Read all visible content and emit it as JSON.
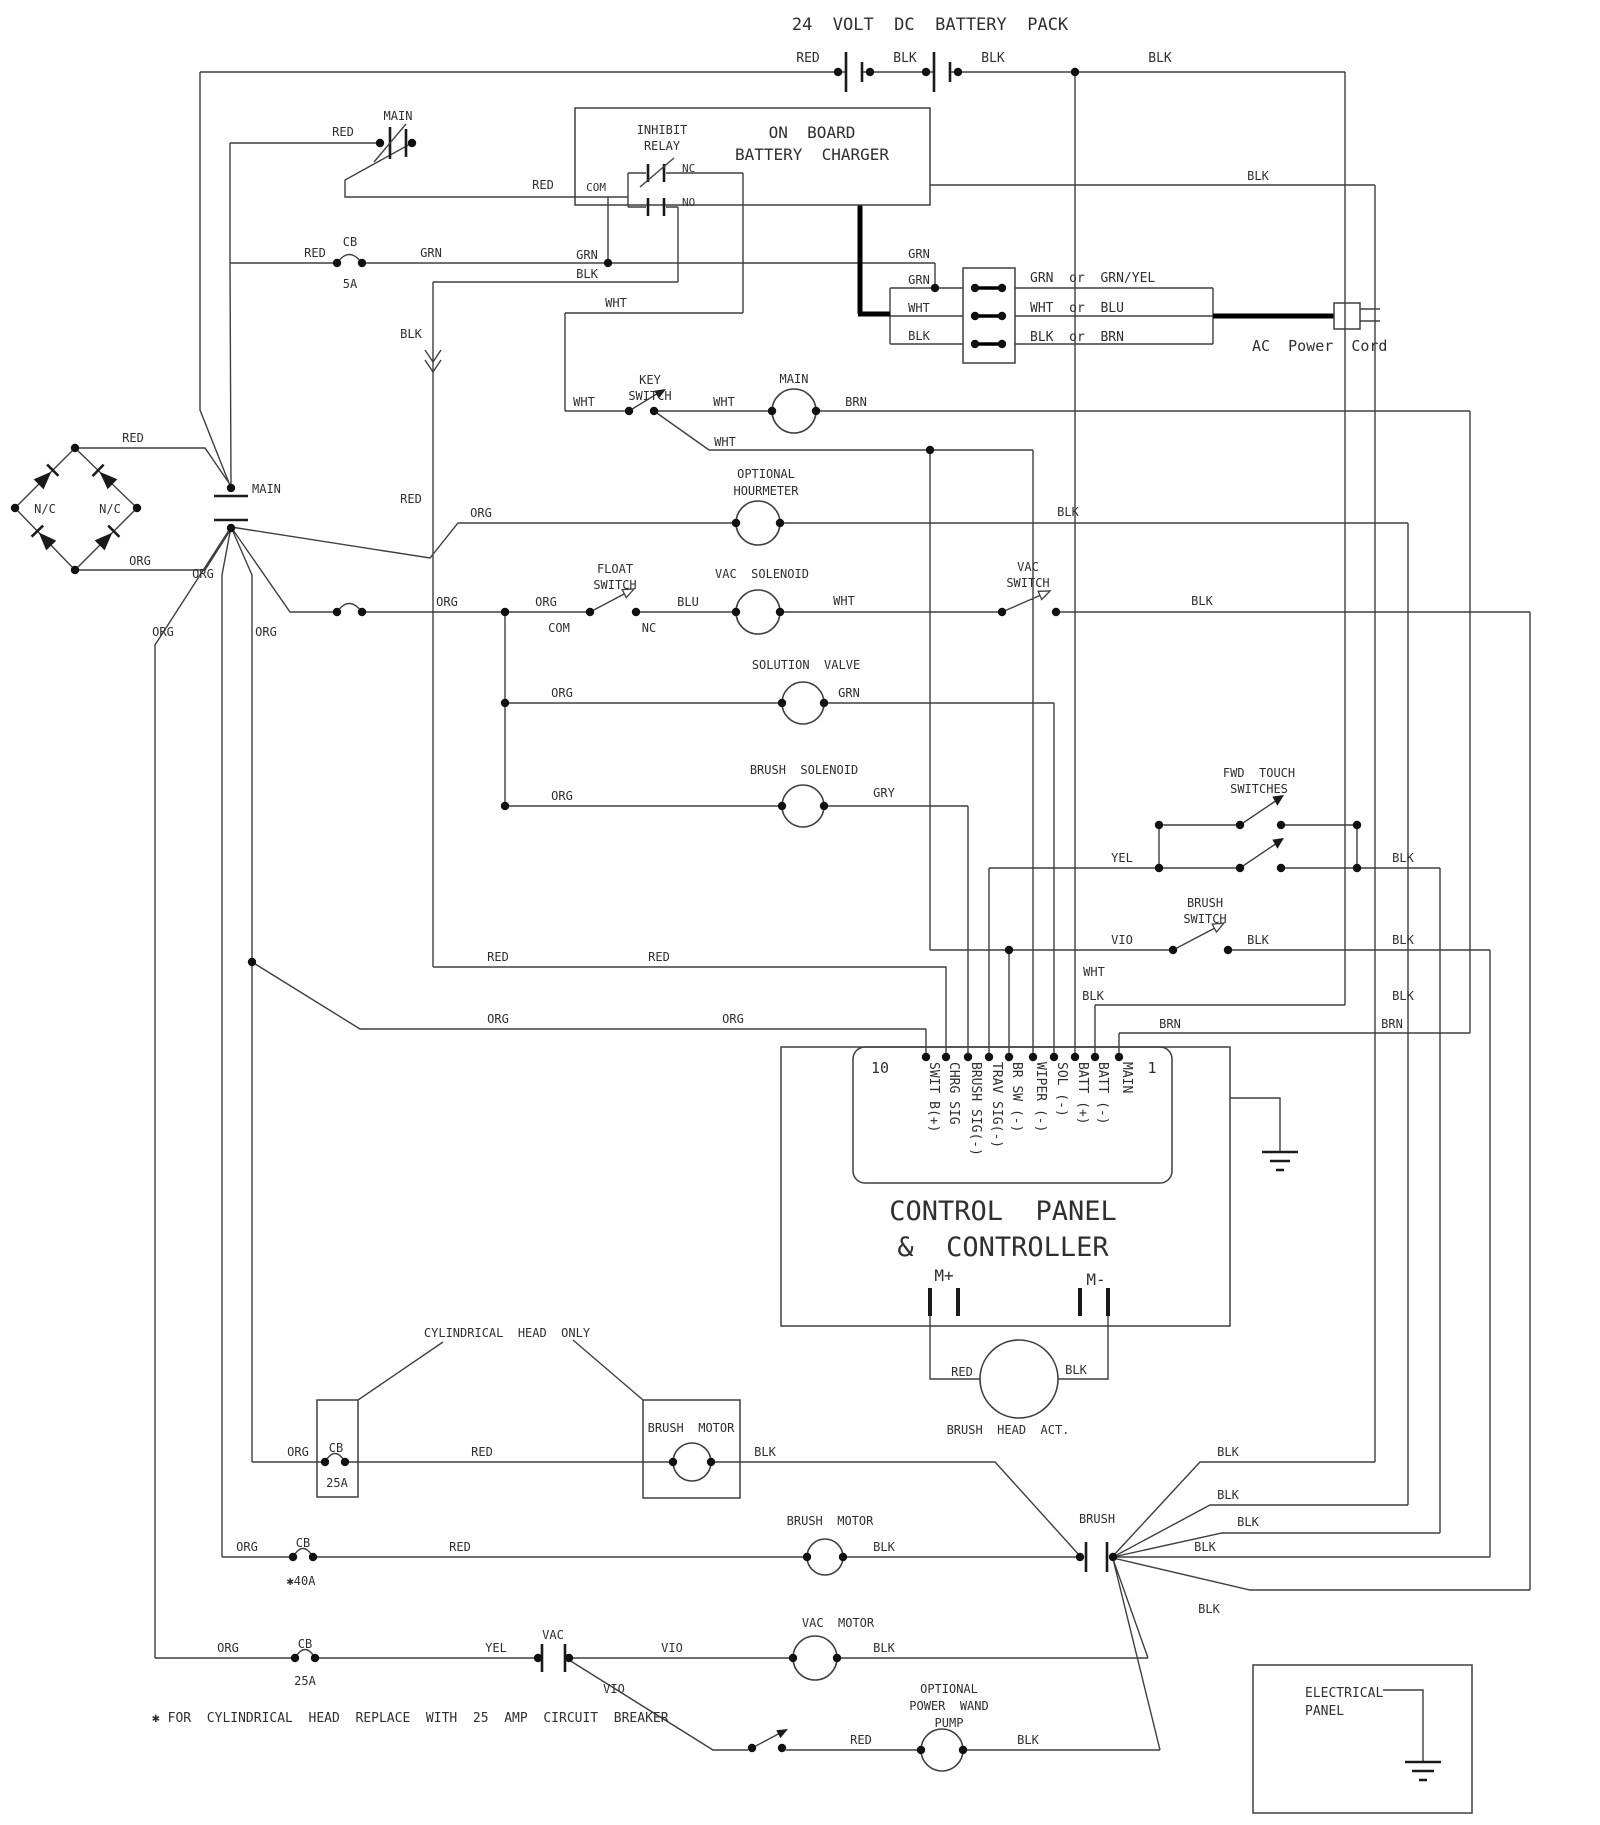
{
  "title": "24  VOLT  DC  BATTERY  PACK",
  "colors": {
    "background": "#ffffff",
    "line": "#3f3f3f",
    "text": "#2f2f2f",
    "thick_cable": "#000000"
  },
  "controller": {
    "pin_first": "1",
    "pin_last": "10",
    "name_line1": "CONTROL  PANEL",
    "name_line2": "&  CONTROLLER",
    "terminals": [
      "M+",
      "M-"
    ]
  },
  "labels": [
    {
      "n": "top-title",
      "t": "24  VOLT  DC  BATTERY  PACK",
      "x": 930,
      "y": 30,
      "a": "middle",
      "s": 17
    },
    {
      "n": "battery-red",
      "t": "RED",
      "x": 808,
      "y": 62,
      "a": "middle",
      "s": 13
    },
    {
      "n": "battery-blk-1",
      "t": "BLK",
      "x": 905,
      "y": 62,
      "a": "middle",
      "s": 13
    },
    {
      "n": "battery-blk-2",
      "t": "BLK",
      "x": 993,
      "y": 62,
      "a": "middle",
      "s": 13
    },
    {
      "n": "battery-blk-3",
      "t": "BLK",
      "x": 1160,
      "y": 62,
      "a": "middle",
      "s": 13
    },
    {
      "n": "main-switch-label",
      "t": "MAIN",
      "x": 398,
      "y": 120,
      "a": "middle",
      "s": 12
    },
    {
      "n": "main-switch-red",
      "t": "RED",
      "x": 343,
      "y": 136,
      "a": "middle",
      "s": 12
    },
    {
      "n": "charger-com-red",
      "t": "RED",
      "x": 543,
      "y": 189,
      "a": "middle",
      "s": 12
    },
    {
      "n": "inhibit-relay-1",
      "t": "INHIBIT",
      "x": 662,
      "y": 134,
      "a": "middle",
      "s": 12
    },
    {
      "n": "inhibit-relay-2",
      "t": "RELAY",
      "x": 662,
      "y": 150,
      "a": "middle",
      "s": 12
    },
    {
      "n": "charger-title-1",
      "t": "ON  BOARD",
      "x": 812,
      "y": 138,
      "a": "middle",
      "s": 16
    },
    {
      "n": "charger-title-2",
      "t": "BATTERY  CHARGER",
      "x": 812,
      "y": 160,
      "a": "middle",
      "s": 16
    },
    {
      "n": "relay-com",
      "t": "COM",
      "x": 606,
      "y": 191,
      "a": "end",
      "s": 11
    },
    {
      "n": "relay-nc",
      "t": "NC",
      "x": 682,
      "y": 172,
      "a": "start",
      "s": 11
    },
    {
      "n": "relay-no",
      "t": "NO",
      "x": 682,
      "y": 206,
      "a": "start",
      "s": 11
    },
    {
      "n": "cb1-label",
      "t": "CB",
      "x": 350,
      "y": 246,
      "a": "middle",
      "s": 12
    },
    {
      "n": "cb1-amps",
      "t": "5A",
      "x": 350,
      "y": 288,
      "a": "middle",
      "s": 12
    },
    {
      "n": "cb1-red",
      "t": "RED",
      "x": 315,
      "y": 257,
      "a": "middle",
      "s": 12
    },
    {
      "n": "cb1-grn",
      "t": "GRN",
      "x": 431,
      "y": 257,
      "a": "middle",
      "s": 12
    },
    {
      "n": "grn-feed",
      "t": "GRN",
      "x": 587,
      "y": 259,
      "a": "middle",
      "s": 12
    },
    {
      "n": "blk-feed",
      "t": "BLK",
      "x": 587,
      "y": 278,
      "a": "middle",
      "s": 12
    },
    {
      "n": "splice-blk",
      "t": "BLK",
      "x": 411,
      "y": 338,
      "a": "middle",
      "s": 12
    },
    {
      "n": "splice-red",
      "t": "RED",
      "x": 411,
      "y": 503,
      "a": "middle",
      "s": 12
    },
    {
      "n": "ac-grn-in",
      "t": "GRN",
      "x": 919,
      "y": 258,
      "a": "middle",
      "s": 12
    },
    {
      "n": "ac-grn",
      "t": "GRN",
      "x": 919,
      "y": 284,
      "a": "middle",
      "s": 12
    },
    {
      "n": "ac-wht",
      "t": "WHT",
      "x": 919,
      "y": 312,
      "a": "middle",
      "s": 12
    },
    {
      "n": "ac-blk",
      "t": "BLK",
      "x": 919,
      "y": 340,
      "a": "middle",
      "s": 12
    },
    {
      "n": "ac-alt-grn",
      "t": "GRN  or  GRN/YEL",
      "x": 1030,
      "y": 282,
      "a": "start",
      "s": 13
    },
    {
      "n": "ac-alt-wht",
      "t": "WHT  or  BLU",
      "x": 1030,
      "y": 312,
      "a": "start",
      "s": 13
    },
    {
      "n": "ac-alt-blk",
      "t": "BLK  or  BRN",
      "x": 1030,
      "y": 341,
      "a": "start",
      "s": 13
    },
    {
      "n": "ac-power-cord",
      "t": "AC  Power  Cord",
      "x": 1252,
      "y": 351,
      "a": "start",
      "s": 15
    },
    {
      "n": "charger-blk-out",
      "t": "BLK",
      "x": 1258,
      "y": 180,
      "a": "middle",
      "s": 12
    },
    {
      "n": "wht-row",
      "t": "WHT",
      "x": 616,
      "y": 307,
      "a": "middle",
      "s": 12
    },
    {
      "n": "keyswitch-wht-in",
      "t": "WHT",
      "x": 584,
      "y": 406,
      "a": "middle",
      "s": 12
    },
    {
      "n": "keyswitch-1",
      "t": "KEY",
      "x": 650,
      "y": 384,
      "a": "middle",
      "s": 12
    },
    {
      "n": "keyswitch-2",
      "t": "SWITCH",
      "x": 650,
      "y": 400,
      "a": "middle",
      "s": 12
    },
    {
      "n": "keyswitch-wht-out",
      "t": "WHT",
      "x": 724,
      "y": 406,
      "a": "middle",
      "s": 12
    },
    {
      "n": "main-coil-label",
      "t": "MAIN",
      "x": 794,
      "y": 383,
      "a": "middle",
      "s": 12
    },
    {
      "n": "main-coil-brn",
      "t": "BRN",
      "x": 856,
      "y": 406,
      "a": "middle",
      "s": 12
    },
    {
      "n": "keyswitch-wht-branch",
      "t": "WHT",
      "x": 725,
      "y": 446,
      "a": "middle",
      "s": 12
    },
    {
      "n": "hourmeter-1",
      "t": "OPTIONAL",
      "x": 766,
      "y": 478,
      "a": "middle",
      "s": 12
    },
    {
      "n": "hourmeter-2",
      "t": "HOURMETER",
      "x": 766,
      "y": 495,
      "a": "middle",
      "s": 12
    },
    {
      "n": "hourmeter-org",
      "t": "ORG",
      "x": 481,
      "y": 517,
      "a": "middle",
      "s": 12
    },
    {
      "n": "hourmeter-blk",
      "t": "BLK",
      "x": 1068,
      "y": 516,
      "a": "middle",
      "s": 12
    },
    {
      "n": "floatswitch-1",
      "t": "FLOAT",
      "x": 615,
      "y": 573,
      "a": "middle",
      "s": 12
    },
    {
      "n": "floatswitch-2",
      "t": "SWITCH",
      "x": 615,
      "y": 589,
      "a": "middle",
      "s": 12
    },
    {
      "n": "floatswitch-org1",
      "t": "ORG",
      "x": 447,
      "y": 606,
      "a": "middle",
      "s": 12
    },
    {
      "n": "floatswitch-org2",
      "t": "ORG",
      "x": 546,
      "y": 606,
      "a": "middle",
      "s": 12
    },
    {
      "n": "floatswitch-com",
      "t": "COM",
      "x": 559,
      "y": 632,
      "a": "middle",
      "s": 12
    },
    {
      "n": "floatswitch-nc",
      "t": "NC",
      "x": 649,
      "y": 632,
      "a": "middle",
      "s": 12
    },
    {
      "n": "vacsolenoid-blu",
      "t": "BLU",
      "x": 688,
      "y": 606,
      "a": "middle",
      "s": 12
    },
    {
      "n": "vacsolenoid-label",
      "t": "VAC  SOLENOID",
      "x": 762,
      "y": 578,
      "a": "middle",
      "s": 12
    },
    {
      "n": "vacsolenoid-wht",
      "t": "WHT",
      "x": 844,
      "y": 605,
      "a": "middle",
      "s": 12
    },
    {
      "n": "vacswitch-1",
      "t": "VAC",
      "x": 1028,
      "y": 571,
      "a": "middle",
      "s": 12
    },
    {
      "n": "vacswitch-2",
      "t": "SWITCH",
      "x": 1028,
      "y": 587,
      "a": "middle",
      "s": 12
    },
    {
      "n": "vacswitch-blk",
      "t": "BLK",
      "x": 1202,
      "y": 605,
      "a": "middle",
      "s": 12
    },
    {
      "n": "solutionvalve-label",
      "t": "SOLUTION  VALVE",
      "x": 806,
      "y": 669,
      "a": "middle",
      "s": 12
    },
    {
      "n": "solutionvalve-org",
      "t": "ORG",
      "x": 562,
      "y": 697,
      "a": "middle",
      "s": 12
    },
    {
      "n": "solutionvalve-grn",
      "t": "GRN",
      "x": 849,
      "y": 697,
      "a": "middle",
      "s": 12
    },
    {
      "n": "brushsolenoid-label",
      "t": "BRUSH  SOLENOID",
      "x": 804,
      "y": 774,
      "a": "middle",
      "s": 12
    },
    {
      "n": "brushsolenoid-org",
      "t": "ORG",
      "x": 562,
      "y": 800,
      "a": "middle",
      "s": 12
    },
    {
      "n": "brushsolenoid-gry",
      "t": "GRY",
      "x": 884,
      "y": 797,
      "a": "middle",
      "s": 12
    },
    {
      "n": "fwdtouch-1",
      "t": "FWD  TOUCH",
      "x": 1259,
      "y": 777,
      "a": "middle",
      "s": 12
    },
    {
      "n": "fwdtouch-2",
      "t": "SWITCHES",
      "x": 1259,
      "y": 793,
      "a": "middle",
      "s": 12
    },
    {
      "n": "fwdtouch-yel",
      "t": "YEL",
      "x": 1122,
      "y": 862,
      "a": "middle",
      "s": 12
    },
    {
      "n": "fwdtouch-blk",
      "t": "BLK",
      "x": 1403,
      "y": 862,
      "a": "middle",
      "s": 12
    },
    {
      "n": "brushswitch-1",
      "t": "BRUSH",
      "x": 1205,
      "y": 907,
      "a": "middle",
      "s": 12
    },
    {
      "n": "brushswitch-2",
      "t": "SWITCH",
      "x": 1205,
      "y": 923,
      "a": "middle",
      "s": 12
    },
    {
      "n": "brushswitch-vio",
      "t": "VIO",
      "x": 1122,
      "y": 944,
      "a": "middle",
      "s": 12
    },
    {
      "n": "brushswitch-wht",
      "t": "WHT",
      "x": 1094,
      "y": 976,
      "a": "middle",
      "s": 12
    },
    {
      "n": "brushswitch-blk1",
      "t": "BLK",
      "x": 1258,
      "y": 944,
      "a": "middle",
      "s": 12
    },
    {
      "n": "brushswitch-blk2",
      "t": "BLK",
      "x": 1403,
      "y": 944,
      "a": "middle",
      "s": 12
    },
    {
      "n": "redrow-1",
      "t": "RED",
      "x": 498,
      "y": 961,
      "a": "middle",
      "s": 12
    },
    {
      "n": "redrow-2",
      "t": "RED",
      "x": 659,
      "y": 961,
      "a": "middle",
      "s": 12
    },
    {
      "n": "orgrow-1",
      "t": "ORG",
      "x": 498,
      "y": 1023,
      "a": "middle",
      "s": 12
    },
    {
      "n": "orgrow-2",
      "t": "ORG",
      "x": 733,
      "y": 1023,
      "a": "middle",
      "s": 12
    },
    {
      "n": "blkrow-1",
      "t": "BLK",
      "x": 1093,
      "y": 1000,
      "a": "middle",
      "s": 12
    },
    {
      "n": "blkrow-2",
      "t": "BLK",
      "x": 1403,
      "y": 1000,
      "a": "middle",
      "s": 12
    },
    {
      "n": "brnrow-1",
      "t": "BRN",
      "x": 1170,
      "y": 1028,
      "a": "middle",
      "s": 12
    },
    {
      "n": "brnrow-2",
      "t": "BRN",
      "x": 1392,
      "y": 1028,
      "a": "middle",
      "s": 12
    },
    {
      "n": "pin-number-10",
      "t": "10",
      "x": 880,
      "y": 1073,
      "a": "middle",
      "s": 15
    },
    {
      "n": "pin-number-1",
      "t": "1",
      "x": 1152,
      "y": 1073,
      "a": "middle",
      "s": 15
    },
    {
      "n": "pin-swit",
      "t": "SWIT B(+)",
      "x": 926,
      "y": 1066,
      "rot": true,
      "s": 13
    },
    {
      "n": "pin-chrg",
      "t": "CHRG SIG",
      "x": 946,
      "y": 1066,
      "rot": true,
      "s": 13
    },
    {
      "n": "pin-brush-sig",
      "t": "BRUSH SIG(-)",
      "x": 968,
      "y": 1066,
      "rot": true,
      "s": 13
    },
    {
      "n": "pin-trav-sig",
      "t": "TRAV SIG(-)",
      "x": 989,
      "y": 1066,
      "rot": true,
      "s": 13
    },
    {
      "n": "pin-br-sw",
      "t": "BR SW (-)",
      "x": 1009,
      "y": 1066,
      "rot": true,
      "s": 13
    },
    {
      "n": "pin-wiper",
      "t": "WIPER (-)",
      "x": 1033,
      "y": 1066,
      "rot": true,
      "s": 13
    },
    {
      "n": "pin-sol",
      "t": "SOL (-)",
      "x": 1054,
      "y": 1066,
      "rot": true,
      "s": 13
    },
    {
      "n": "pin-batt-plus",
      "t": "BATT (+)",
      "x": 1075,
      "y": 1066,
      "rot": true,
      "s": 13
    },
    {
      "n": "pin-batt-minus",
      "t": "BATT (-)",
      "x": 1095,
      "y": 1066,
      "rot": true,
      "s": 13
    },
    {
      "n": "pin-main",
      "t": "MAIN",
      "x": 1119,
      "y": 1066,
      "rot": true,
      "s": 13
    },
    {
      "n": "controller-name-1",
      "t": "CONTROL  PANEL",
      "x": 1003,
      "y": 1220,
      "a": "middle",
      "s": 27
    },
    {
      "n": "controller-name-2",
      "t": "&  CONTROLLER",
      "x": 1003,
      "y": 1256,
      "a": "middle",
      "s": 27
    },
    {
      "n": "terminal-m-plus",
      "t": "M+",
      "x": 944,
      "y": 1281,
      "a": "middle",
      "s": 16
    },
    {
      "n": "terminal-m-minus",
      "t": "M-",
      "x": 1096,
      "y": 1285,
      "a": "middle",
      "s": 16
    },
    {
      "n": "act-red",
      "t": "RED",
      "x": 962,
      "y": 1376,
      "a": "middle",
      "s": 12
    },
    {
      "n": "act-blk",
      "t": "BLK",
      "x": 1076,
      "y": 1374,
      "a": "middle",
      "s": 12
    },
    {
      "n": "act-label",
      "t": "BRUSH  HEAD  ACT.",
      "x": 1008,
      "y": 1434,
      "a": "middle",
      "s": 12
    },
    {
      "n": "cylindrical-callout",
      "t": "CYLINDRICAL  HEAD  ONLY",
      "x": 507,
      "y": 1337,
      "a": "middle",
      "s": 12
    },
    {
      "n": "cb2-org",
      "t": "ORG",
      "x": 298,
      "y": 1456,
      "a": "middle",
      "s": 12
    },
    {
      "n": "cb2-label",
      "t": "CB",
      "x": 336,
      "y": 1452,
      "a": "middle",
      "s": 12
    },
    {
      "n": "cb2-amps",
      "t": "25A",
      "x": 337,
      "y": 1487,
      "a": "middle",
      "s": 12
    },
    {
      "n": "brushmotor1-red",
      "t": "RED",
      "x": 482,
      "y": 1456,
      "a": "middle",
      "s": 12
    },
    {
      "n": "brushmotor1-label",
      "t": "BRUSH  MOTOR",
      "x": 691,
      "y": 1432,
      "a": "middle",
      "s": 12
    },
    {
      "n": "brushmotor1-blk",
      "t": "BLK",
      "x": 765,
      "y": 1456,
      "a": "middle",
      "s": 12
    },
    {
      "n": "brush-contact-label",
      "t": "BRUSH",
      "x": 1097,
      "y": 1523,
      "a": "middle",
      "s": 12
    },
    {
      "n": "fan-blk-1",
      "t": "BLK",
      "x": 1228,
      "y": 1456,
      "a": "middle",
      "s": 12
    },
    {
      "n": "fan-blk-2",
      "t": "BLK",
      "x": 1228,
      "y": 1499,
      "a": "middle",
      "s": 12
    },
    {
      "n": "fan-blk-3",
      "t": "BLK",
      "x": 1248,
      "y": 1526,
      "a": "middle",
      "s": 12
    },
    {
      "n": "fan-blk-4",
      "t": "BLK",
      "x": 1205,
      "y": 1551,
      "a": "middle",
      "s": 12
    },
    {
      "n": "fan-blk-5",
      "t": "BLK",
      "x": 1209,
      "y": 1613,
      "a": "middle",
      "s": 12
    },
    {
      "n": "cb3-org",
      "t": "ORG",
      "x": 247,
      "y": 1551,
      "a": "middle",
      "s": 12
    },
    {
      "n": "cb3-label",
      "t": "CB",
      "x": 303,
      "y": 1547,
      "a": "middle",
      "s": 12
    },
    {
      "n": "cb3-amps",
      "t": "✱40A",
      "x": 301,
      "y": 1585,
      "a": "middle",
      "s": 12
    },
    {
      "n": "brushmotor2-red",
      "t": "RED",
      "x": 460,
      "y": 1551,
      "a": "middle",
      "s": 12
    },
    {
      "n": "brushmotor2-label",
      "t": "BRUSH  MOTOR",
      "x": 830,
      "y": 1525,
      "a": "middle",
      "s": 12
    },
    {
      "n": "brushmotor2-blk",
      "t": "BLK",
      "x": 884,
      "y": 1551,
      "a": "middle",
      "s": 12
    },
    {
      "n": "cb4-org",
      "t": "ORG",
      "x": 228,
      "y": 1652,
      "a": "middle",
      "s": 12
    },
    {
      "n": "cb4-label",
      "t": "CB",
      "x": 305,
      "y": 1648,
      "a": "middle",
      "s": 12
    },
    {
      "n": "cb4-amps",
      "t": "25A",
      "x": 305,
      "y": 1685,
      "a": "middle",
      "s": 12
    },
    {
      "n": "vacmotor-yel",
      "t": "YEL",
      "x": 496,
      "y": 1652,
      "a": "middle",
      "s": 12
    },
    {
      "n": "vac-contact-label",
      "t": "VAC",
      "x": 553,
      "y": 1639,
      "a": "middle",
      "s": 12
    },
    {
      "n": "vacmotor-vio",
      "t": "VIO",
      "x": 672,
      "y": 1652,
      "a": "middle",
      "s": 12
    },
    {
      "n": "vacmotor-label",
      "t": "VAC  MOTOR",
      "x": 838,
      "y": 1627,
      "a": "middle",
      "s": 12
    },
    {
      "n": "vacmotor-blk",
      "t": "BLK",
      "x": 884,
      "y": 1652,
      "a": "middle",
      "s": 12
    },
    {
      "n": "pump-vio",
      "t": "VIO",
      "x": 614,
      "y": 1693,
      "a": "middle",
      "s": 12
    },
    {
      "n": "pump-red",
      "t": "RED",
      "x": 861,
      "y": 1744,
      "a": "middle",
      "s": 12
    },
    {
      "n": "pump-1",
      "t": "OPTIONAL",
      "x": 949,
      "y": 1693,
      "a": "middle",
      "s": 12
    },
    {
      "n": "pump-2",
      "t": "POWER  WAND",
      "x": 949,
      "y": 1710,
      "a": "middle",
      "s": 12
    },
    {
      "n": "pump-3",
      "t": "PUMP",
      "x": 949,
      "y": 1727,
      "a": "middle",
      "s": 12
    },
    {
      "n": "pump-blk",
      "t": "BLK",
      "x": 1028,
      "y": 1744,
      "a": "middle",
      "s": 12
    },
    {
      "n": "footnote",
      "t": "✱ FOR  CYLINDRICAL  HEAD  REPLACE  WITH  25  AMP  CIRCUIT  BREAKER",
      "x": 152,
      "y": 1722,
      "a": "start",
      "s": 13
    },
    {
      "n": "electrical-panel-1",
      "t": "ELECTRICAL",
      "x": 1305,
      "y": 1697,
      "a": "start",
      "s": 13
    },
    {
      "n": "electrical-panel-2",
      "t": "PANEL",
      "x": 1305,
      "y": 1715,
      "a": "start",
      "s": 13
    },
    {
      "n": "bridge-red",
      "t": "RED",
      "x": 133,
      "y": 442,
      "a": "middle",
      "s": 12
    },
    {
      "n": "bridge-org",
      "t": "ORG",
      "x": 140,
      "y": 565,
      "a": "middle",
      "s": 12
    },
    {
      "n": "bridge-nc-left",
      "t": "N/C",
      "x": 45,
      "y": 513,
      "a": "middle",
      "s": 12
    },
    {
      "n": "bridge-nc-right",
      "t": "N/C",
      "x": 110,
      "y": 513,
      "a": "middle",
      "s": 12
    },
    {
      "n": "main-disconnect-label",
      "t": "MAIN",
      "x": 252,
      "y": 493,
      "a": "start",
      "s": 12
    },
    {
      "n": "bus-org-1",
      "t": "ORG",
      "x": 203,
      "y": 578,
      "a": "middle",
      "s": 12
    },
    {
      "n": "bus-org-2",
      "t": "ORG",
      "x": 163,
      "y": 636,
      "a": "middle",
      "s": 12
    },
    {
      "n": "bus-org-3",
      "t": "ORG",
      "x": 266,
      "y": 636,
      "a": "middle",
      "s": 12
    }
  ]
}
